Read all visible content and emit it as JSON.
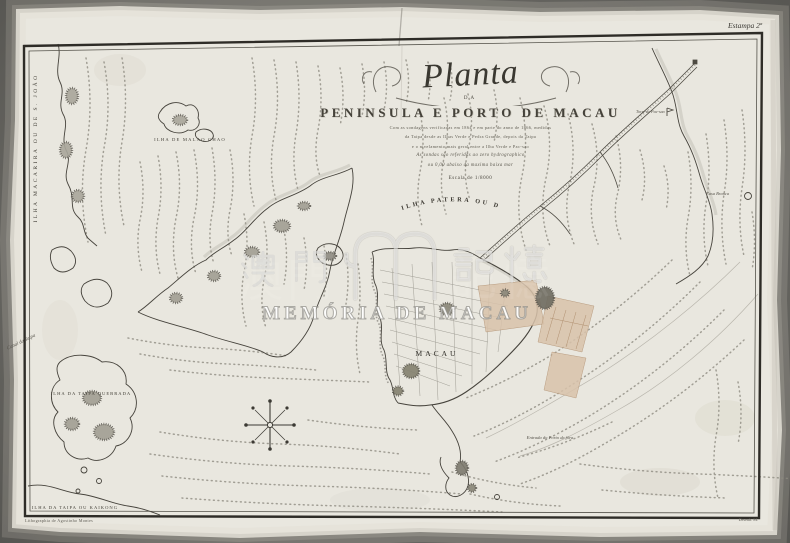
{
  "scan": {
    "plate_note": "Estampa 2ª",
    "imprint_left": "Lithographia de Agostinho Montes",
    "imprint_right": "Desenh. M."
  },
  "title": {
    "script": "Planta",
    "connector": "DA",
    "main": "PENINSULA E PORTO DE MACAU",
    "subtitle_lines": [
      "Com as sondagens verificadas em 1864 e em parte do anno de 1866, medidas",
      "da Taipa desde as Ilhas Verde e Pedra Grande, depois da Taipa",
      "e o nivelamento mais geral entre a Ilha Verde e Pac-sao",
      "As sondas são referidas ao zero hydrographico",
      "ou 0,00 abaixo da maxima baixa mar"
    ],
    "scale_note": "Escala de 1/8000"
  },
  "labels": {
    "ilha_macarira": "ILHA MACARIRA OU DE S. JOÃO",
    "ilha_de_malao_chao": "ILHA DE MALAO CHAO",
    "ilha_patera_ou_da_lapa": "ILHA PATERA OU DA LAPA",
    "macau": "MACAU",
    "ilha_da_taipa_quebrada": "ILHA DA TAIPA QUEBRADA",
    "ilha_da_taipa_ou_kaikong": "ILHA DA TAIPA OU KAIKONG",
    "canal_da_taipa": "Canal da Taipa",
    "entrada_do_porto": "Entrada do Porto de fóra",
    "casa_branca": "Casa Branca",
    "torre_de_pacsao": "Torre de Pac-sao"
  },
  "watermark": {
    "cjk_left": "澳門",
    "cjk_right": "記憶",
    "caption": "MEMÓRIA DE MACAU"
  },
  "colors": {
    "background": "#6a6964",
    "paper": "#e9e7df",
    "ink": "#46433c",
    "city_block": "#d9c3ab"
  }
}
